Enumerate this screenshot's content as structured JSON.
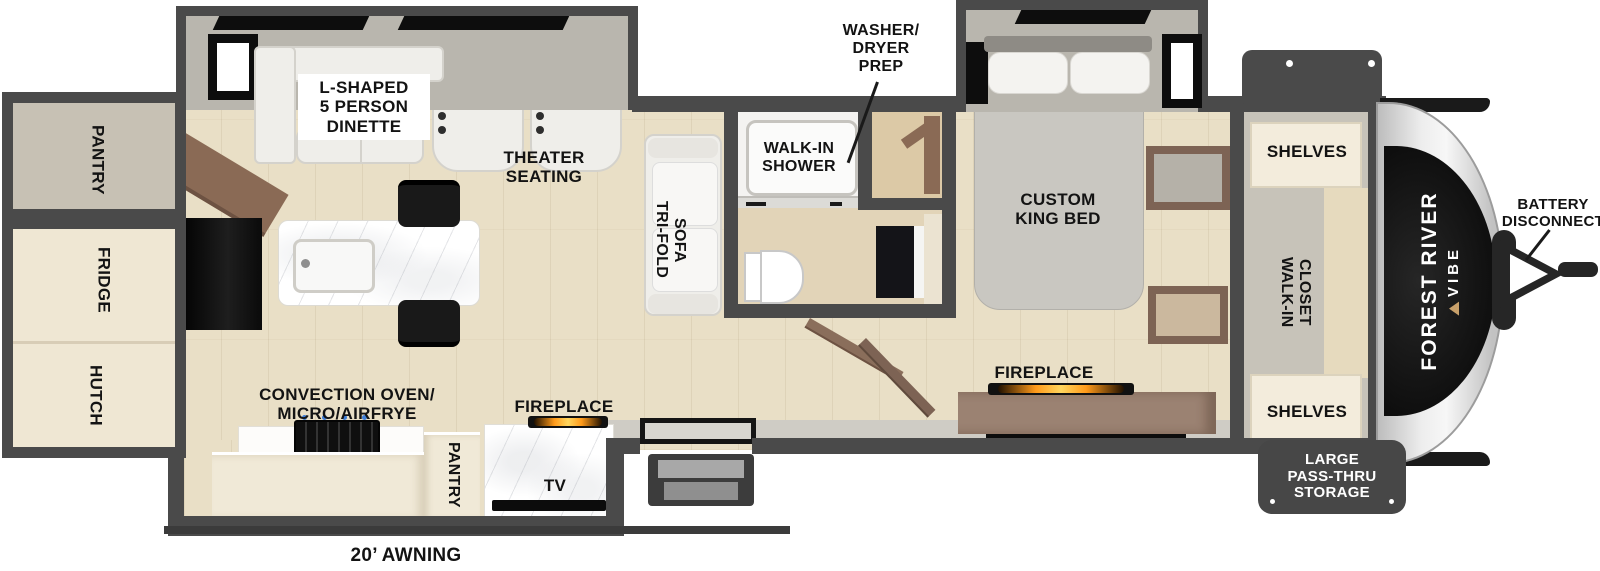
{
  "plan": {
    "brand": {
      "line1": "FOREST RIVER",
      "line2": "VIBE"
    },
    "labels": {
      "rear_pantry": "PANTRY",
      "fridge": "FRIDGE",
      "hutch": "HUTCH",
      "dinette": "L-SHAPED\n5 PERSON\nDINETTE",
      "theater_seating": "THEATER\nSEATING",
      "tri_fold_sofa": "TRI-FOLD\nSOFA",
      "walk_in_shower": "WALK-IN\nSHOWER",
      "washer_dryer_prep": "WASHER/\nDRYER\nPREP",
      "custom_king_bed": "CUSTOM\nKING BED",
      "bedroom_fireplace": "FIREPLACE",
      "shelves_top": "SHELVES",
      "walk_in_closet": "WALK-IN\nCLOSET",
      "shelves_bottom": "SHELVES",
      "battery_disconnect": "BATTERY\nDISCONNECT",
      "pass_thru_storage": "LARGE\nPASS-THRU\nSTORAGE",
      "convection": "CONVECTION OVEN/\nMICRO/AIRFRYE",
      "kitchen_pantry": "PANTRY",
      "living_fireplace": "FIREPLACE",
      "tv": "TV",
      "awning": "20’ AWNING"
    },
    "colors": {
      "wall": "#4a4a4a",
      "slide_interior": "#b9b6ae",
      "floor_wood": "#e9dfc6",
      "cabinet_cream": "#f0e9d7",
      "wood_brown": "#8a6a55",
      "label_text": "#131313",
      "flame_orange": "#ff9a1a",
      "front_cap_black": "#141414"
    }
  }
}
